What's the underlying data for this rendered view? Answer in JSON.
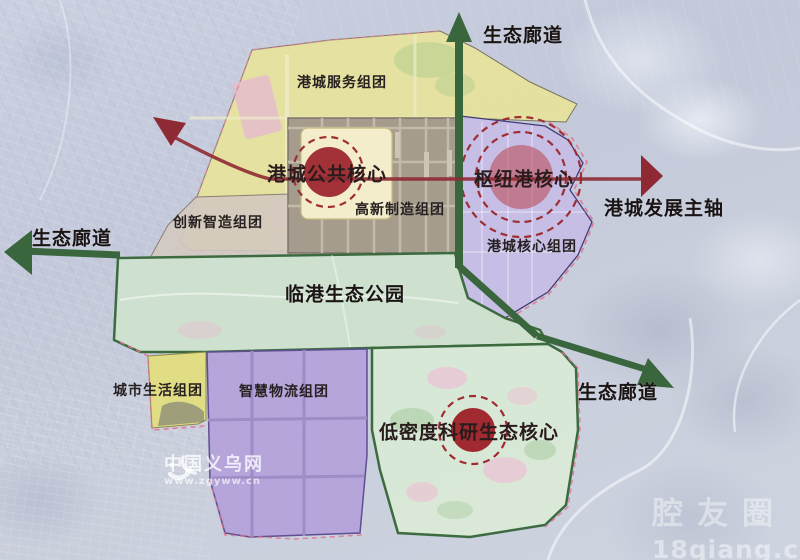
{
  "labels": {
    "corridor_top": "生态廊道",
    "corridor_left": "生态廊道",
    "corridor_bottom_right": "生态廊道",
    "development_axis": "港城发展主轴",
    "service_cluster": "港城服务组团",
    "public_core": "港城公共核心",
    "hub_port_core": "枢纽港核心",
    "innovation_cluster": "创新智造组团",
    "hightech_cluster": "高新制造组团",
    "port_core_cluster": "港城核心组团",
    "eco_park": "临港生态公园",
    "city_life_cluster": "城市生活组团",
    "smart_logistics_cluster": "智慧物流组团",
    "research_core": "低密度科研生态核心"
  },
  "watermarks": {
    "yiwu_site_name": "中国义乌网",
    "yiwu_site_url": "www.zgyww.cn",
    "qiang_name": "腔友圈",
    "qiang_url": "18qiang.com"
  },
  "colors": {
    "corridor_green": "#3c6b40",
    "axis_red": "#8e2a33",
    "core_red": "#a02a30",
    "service_yellow": "#e7e39b",
    "hub_purple": "#c7bce6",
    "logistics_purple": "#b4a2d9",
    "park_green": "#cfe2cd",
    "industrial_grey": "#a59c8d",
    "life_yellow": "#e2dd7f",
    "boundary_pink": "#e0708e"
  }
}
